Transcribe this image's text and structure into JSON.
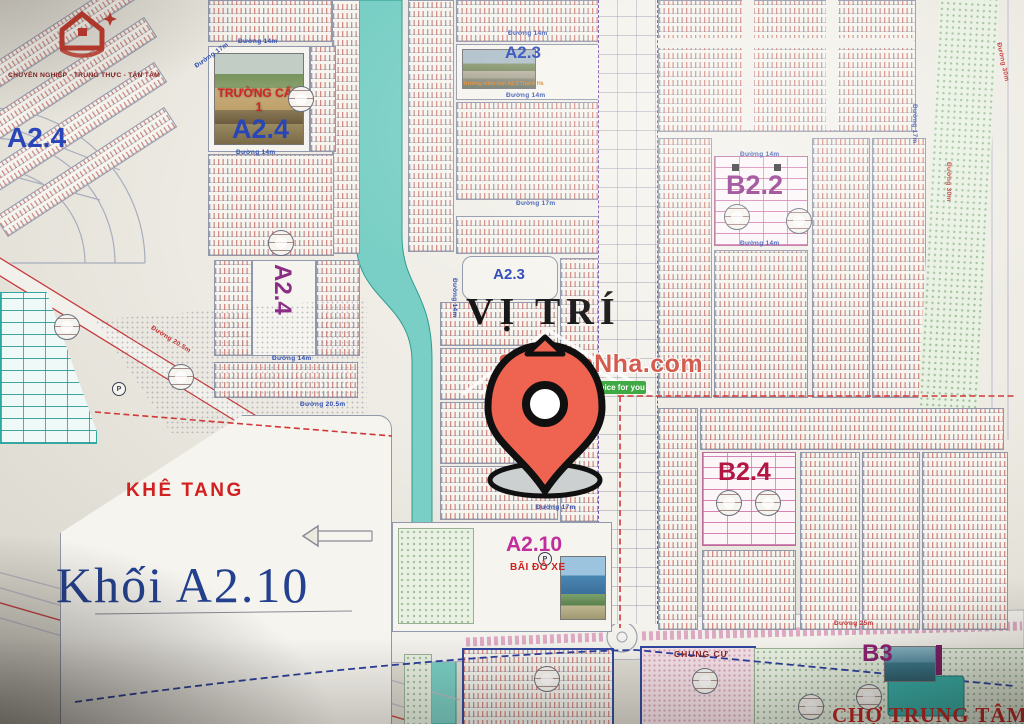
{
  "branding": {
    "logo_icon": "red-house-logo",
    "tagline": "CHUYÊN NGHIỆP - TRUNG THỰC - TẬN TÂM"
  },
  "watermark": {
    "brand": "SoSanhNha.com",
    "slogan": "Great choice for you"
  },
  "zones": {
    "a24_corner": "A2.4",
    "a24_school": "A2.4",
    "a24_vertical": "A2.4",
    "a23_top": "A2.3",
    "a23_center": "A2.3",
    "b22": "B2.2",
    "b24": "B2.4",
    "a210": "A2.10",
    "khoi_a210": "Khối A2.10",
    "b3": "B3"
  },
  "places": {
    "vi_tri": "VỊ TRÍ",
    "khe_tang": "KHÊ TANG",
    "bai_do_xe": "BÃI ĐỖ XE",
    "chung_cu": "CHUNG CƯ",
    "cho_trung_tam": "CHỢ TRUNG TÂM",
    "truong_cap_1": "TRƯỜNG CẤP 1",
    "truong_mam_non_caption": "Trường mầm non A2.3 Thanh Hà"
  },
  "symbols": {
    "parking": "P"
  },
  "roads": [
    {
      "label": "Đường 14m"
    },
    {
      "label": "Đường 14m"
    },
    {
      "label": "Đường 14m"
    },
    {
      "label": "Đường 14m"
    },
    {
      "label": "Đường 17m"
    },
    {
      "label": "Đường 14m"
    },
    {
      "label": "Đường 20.5m"
    },
    {
      "label": "Đường 20.5m"
    },
    {
      "label": "Đường 14m"
    },
    {
      "label": "Đường 14m"
    },
    {
      "label": "Đường 30m"
    },
    {
      "label": "Đường 17m"
    },
    {
      "label": "Đường 25m"
    },
    {
      "label": "Đường 14m"
    },
    {
      "label": "Đường 17m"
    },
    {
      "label": "Đường 30m"
    },
    {
      "label": "Đường 17m"
    }
  ],
  "colors": {
    "zone_blue": "#2846b8",
    "zone_magenta": "#8c2d86",
    "zone_crimson": "#b11742",
    "zone_pink": "#bf2e9a",
    "label_red": "#d02525",
    "navy_serif": "#23418f",
    "river_teal": "#79cfc5",
    "pin": "#ef6351",
    "ribbon_green": "#3fa944",
    "brand_red": "#cd463a"
  }
}
